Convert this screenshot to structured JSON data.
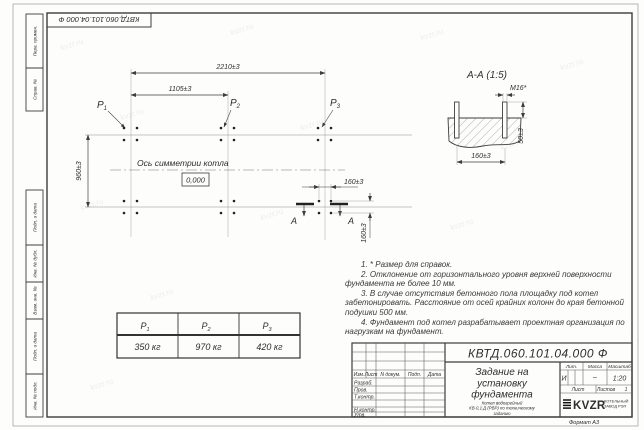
{
  "sheet": {
    "top_designation": "КВТД.060.101.04.000 Ф",
    "format_label": "Формат А3"
  },
  "side_panel": {
    "perv_primen": "Перв. примен.",
    "sprav_n": "Справ. №",
    "podp_data_1": "Подп. и дата",
    "inv_dubl": "Инв. № дубл.",
    "vzam_inv": "Взам. инв. №",
    "podp_data_2": "Подп. и дата",
    "inv_podl": "Инв. № подл."
  },
  "plan": {
    "dim_total": "2210±3",
    "dim_half": "1105±3",
    "dim_rows": "960±3",
    "dim_bolt_h": "160±3",
    "dim_bolt_v": "160±3",
    "p_label": "P",
    "points": [
      "1",
      "2",
      "3"
    ],
    "axis_label": "Ось симметрии котла",
    "level_mark": "0,000",
    "section_letter_left": "А",
    "section_letter_right": "А"
  },
  "section": {
    "title": "А-А (1:5)",
    "bolt_thread": "М16*",
    "dim_spacing": "160±3",
    "dim_protrusion": "50±3"
  },
  "notes": {
    "n1": "1. * Размер для справок.",
    "n2": "2. Отклонение от горизонтального уровня верхней поверхности фундамента не более 10 мм.",
    "n3": "3. В случае отсутствия бетонного пола площадку под котел забетонировать. Расстояние от осей крайних колонн до края бетонной подушки 500 мм.",
    "n4": "4. Фундамент под котел разрабатывает проектная организация по нагрузкам на фундамент."
  },
  "loads": {
    "p_label": "P",
    "subs": [
      "1",
      "2",
      "3"
    ],
    "values": [
      "350 кг",
      "970 кг",
      "420 кг"
    ]
  },
  "title_block": {
    "designation": "КВТД.060.101.04.000 Ф",
    "title_line1": "Задание на",
    "title_line2": "установку",
    "title_line3": "фундамента",
    "doc_line1": "Котел водогрейный",
    "doc_line2": "КВ-0,1 Д (РВР) по техническому",
    "doc_line3": "заданию",
    "col_izm": "Изм.",
    "col_list": "Лист",
    "col_ndoc": "N докум.",
    "col_podp": "Подп.",
    "col_data": "Дата",
    "role_razrab": "Разраб.",
    "role_prov": "Пров.",
    "role_tkontr": "Т.контр.",
    "role_nkontr": "Н.контр.",
    "role_utv": "Утв.",
    "lit_header": "Лит.",
    "mass_header": "Масса",
    "scale_header": "Масштаб",
    "lit_value": "И",
    "mass_value": "–",
    "scale_value": "1:20",
    "sheet_label": "Лист",
    "sheets_label": "Листов",
    "sheets_value": "1",
    "logo_text": "KVZR",
    "logo_line1": "КОТЕЛЬНЫЙ",
    "logo_line2": "ЗАВОД РЭП"
  },
  "watermark": {
    "text": "kvzr.ru"
  }
}
